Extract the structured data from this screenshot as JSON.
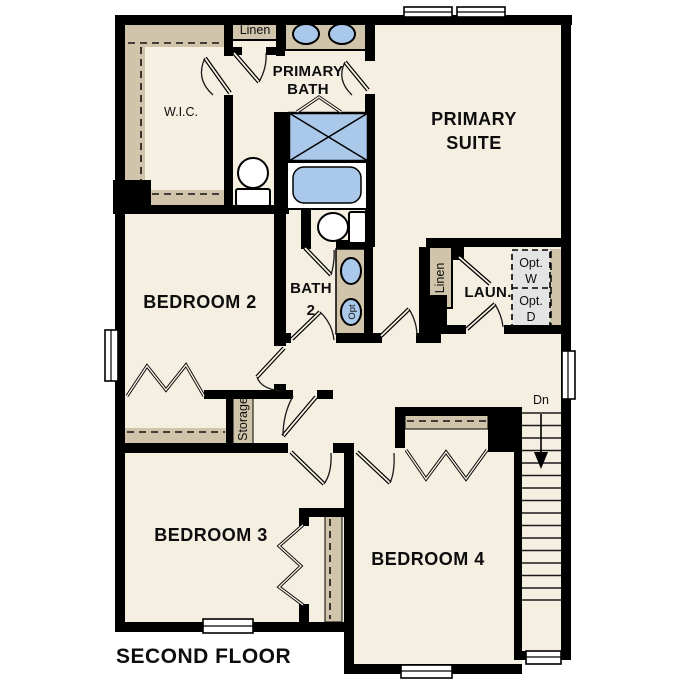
{
  "floor_plan": {
    "title": "SECOND FLOOR",
    "rooms": {
      "primary_suite": {
        "label_line1": "PRIMARY",
        "label_line2": "SUITE"
      },
      "primary_bath": {
        "label_line1": "PRIMARY",
        "label_line2": "BATH"
      },
      "wic": {
        "label": "W.I.C."
      },
      "bedroom2": {
        "label": "BEDROOM 2"
      },
      "bath2": {
        "label_line1": "BATH",
        "label_line2": "2"
      },
      "laundry": {
        "label": "LAUN."
      },
      "bedroom3": {
        "label": "BEDROOM 3"
      },
      "bedroom4": {
        "label": "BEDROOM 4"
      }
    },
    "closets": {
      "linen_upper": {
        "label": "Linen"
      },
      "linen_laundry": {
        "label": "Linen"
      },
      "storage": {
        "label": "Storage"
      }
    },
    "appliances": {
      "optional_washer": {
        "label_line1": "Opt.",
        "label_line2": "W"
      },
      "optional_dryer": {
        "label_line1": "Opt.",
        "label_line2": "D"
      }
    },
    "fixtures": {
      "optional_sink_label": "Opt"
    },
    "stairs": {
      "direction_label": "Dn"
    },
    "colors": {
      "floor": "#f5efe2",
      "shelving_tan": "#d0c4aa",
      "fixture_blue": "#aac8ea",
      "appliance_gray": "#e4e4e4",
      "wall": "#000000",
      "background": "#ffffff"
    }
  }
}
